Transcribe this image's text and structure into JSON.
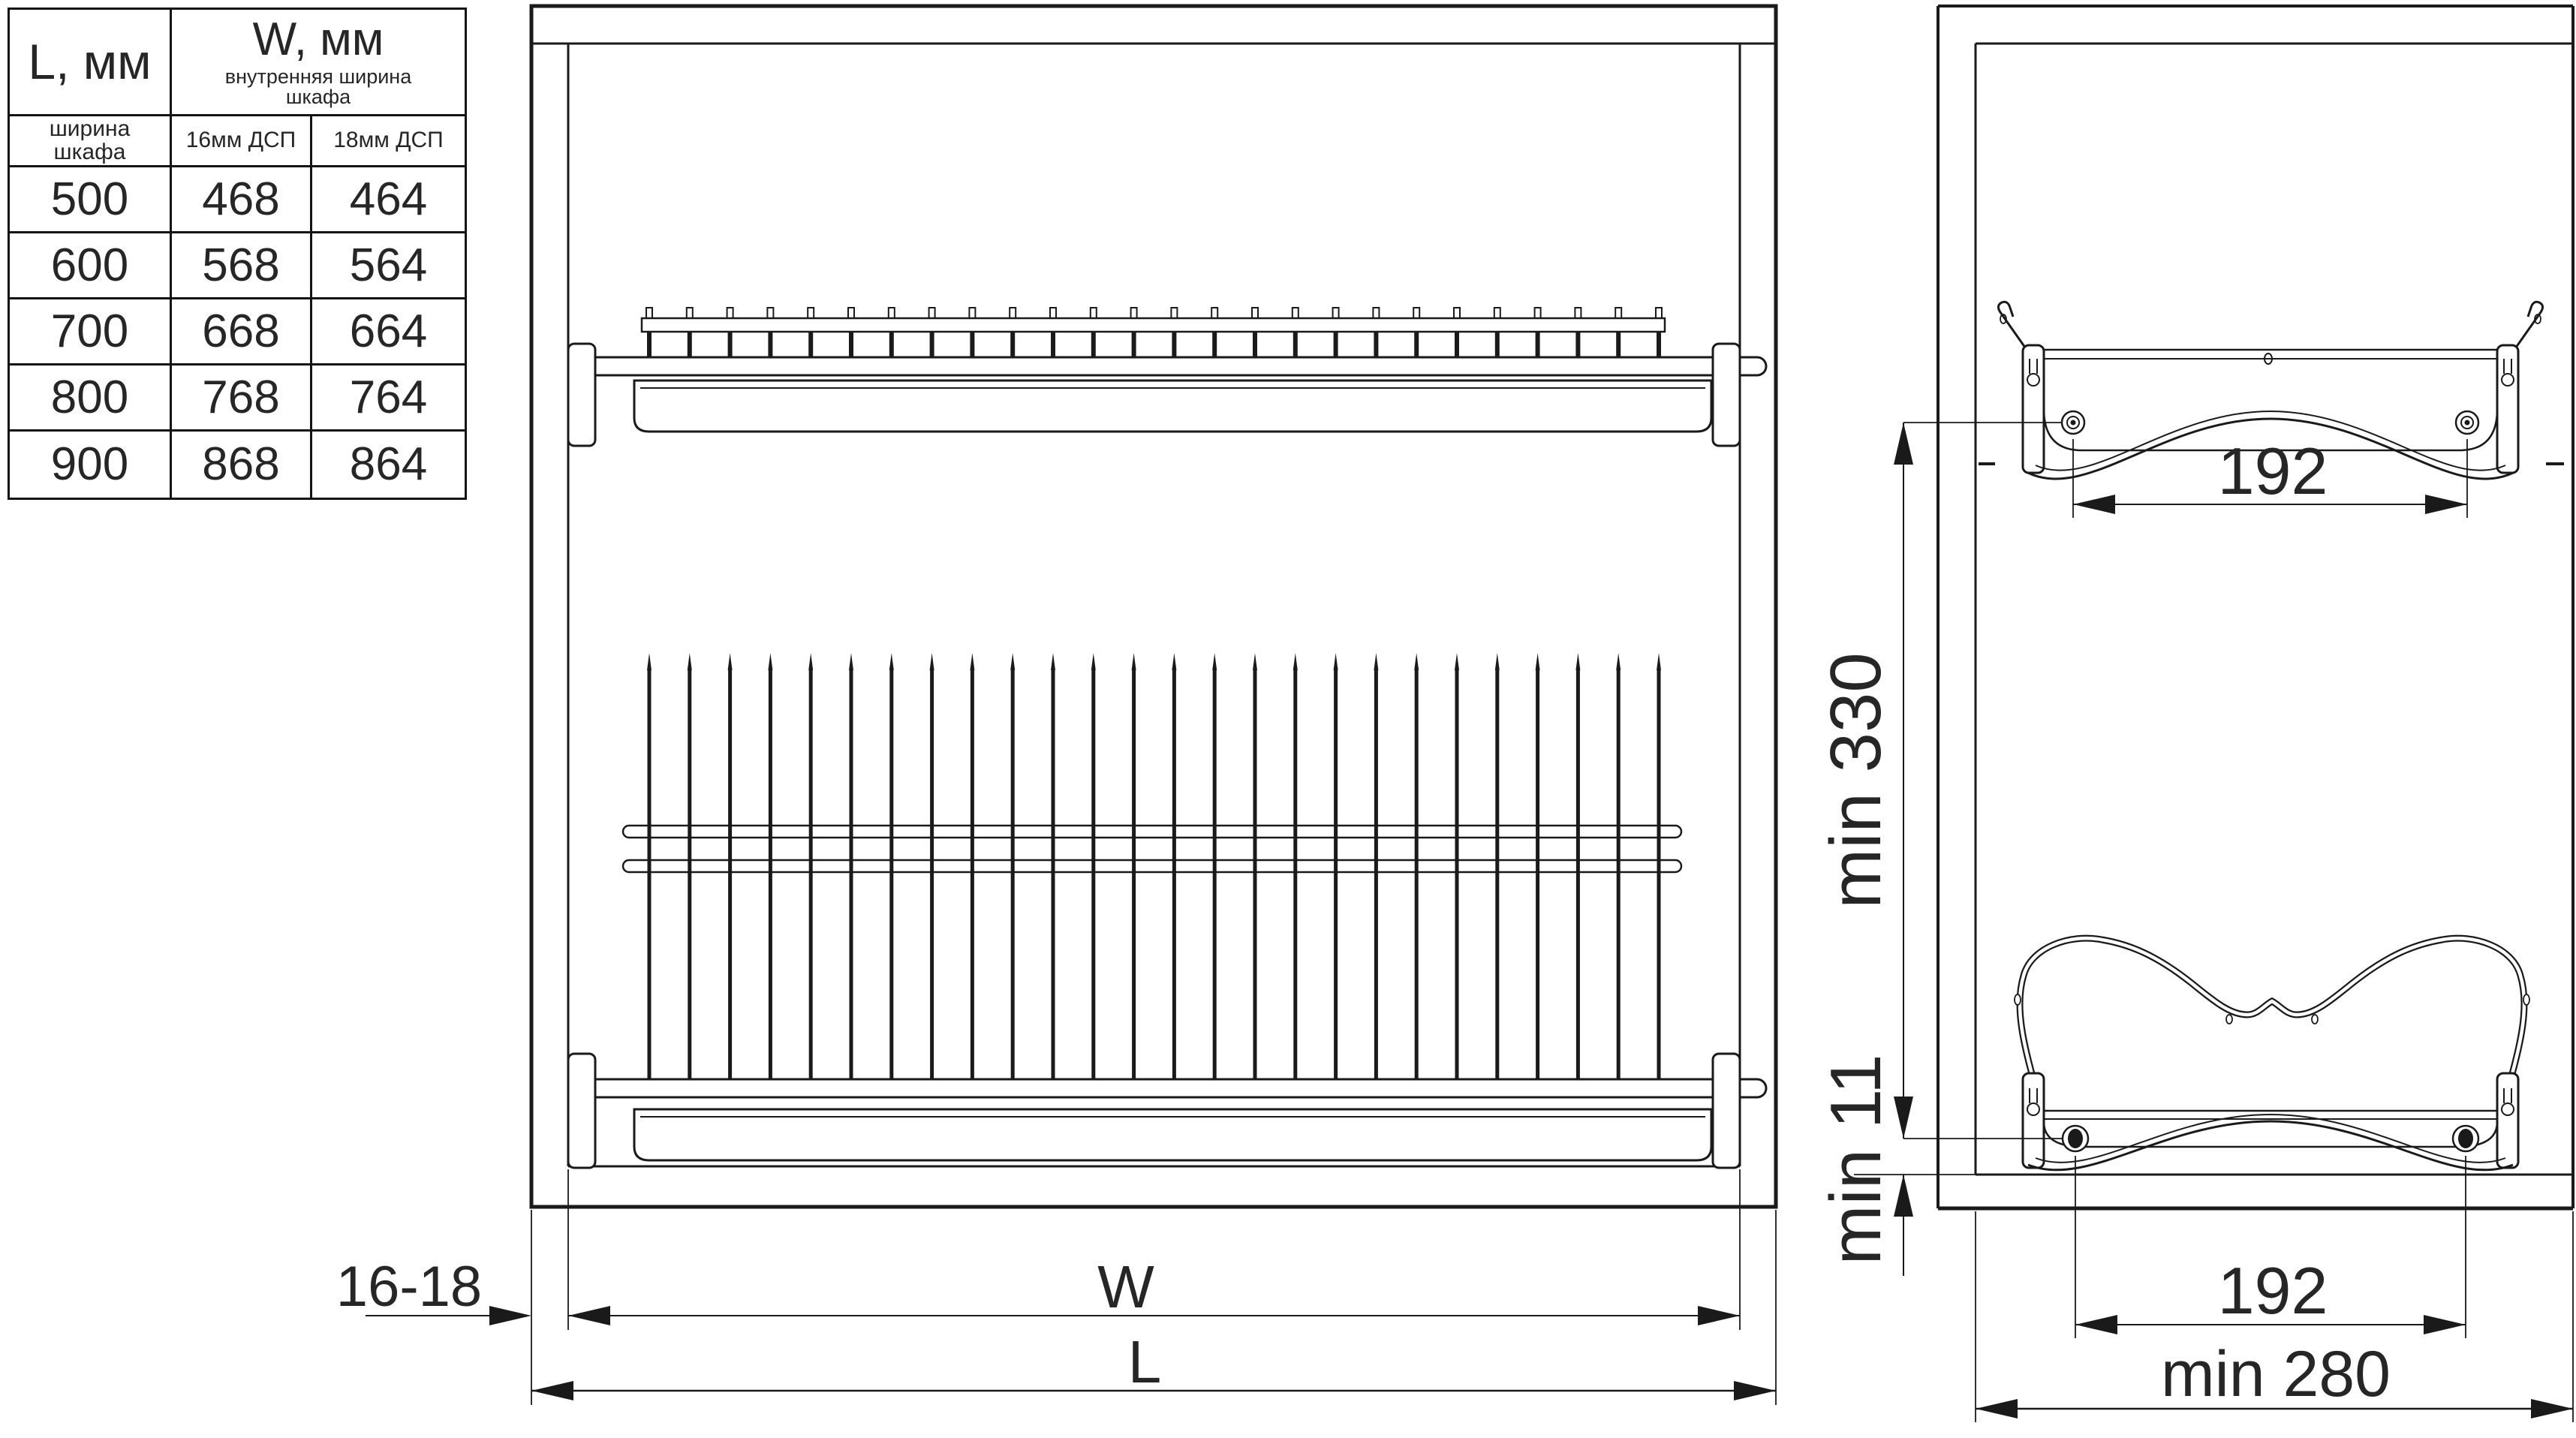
{
  "table": {
    "col1_header": "L, мм",
    "col2_header": "W, мм",
    "col2_subheader": "внутренняя ширина\nшкафа",
    "sub_headers": [
      "ширина\nшкафа",
      "16мм ДСП",
      "18мм ДСП"
    ],
    "rows": [
      [
        "500",
        "468",
        "464"
      ],
      [
        "600",
        "568",
        "564"
      ],
      [
        "700",
        "668",
        "664"
      ],
      [
        "800",
        "768",
        "764"
      ],
      [
        "900",
        "868",
        "864"
      ]
    ]
  },
  "front_view": {
    "label_wall_thickness": "16-18",
    "label_inner_width": "W",
    "label_outer_width": "L",
    "post_count": 26,
    "pin_count": 26
  },
  "side_view": {
    "label_top_span": "192",
    "label_bottom_span": "192",
    "label_min_height": "min 330",
    "label_min_offset": "min 11",
    "label_min_depth": "min 280"
  },
  "colors": {
    "line": "#1a1a1a",
    "text": "#262626",
    "background": "#ffffff"
  }
}
